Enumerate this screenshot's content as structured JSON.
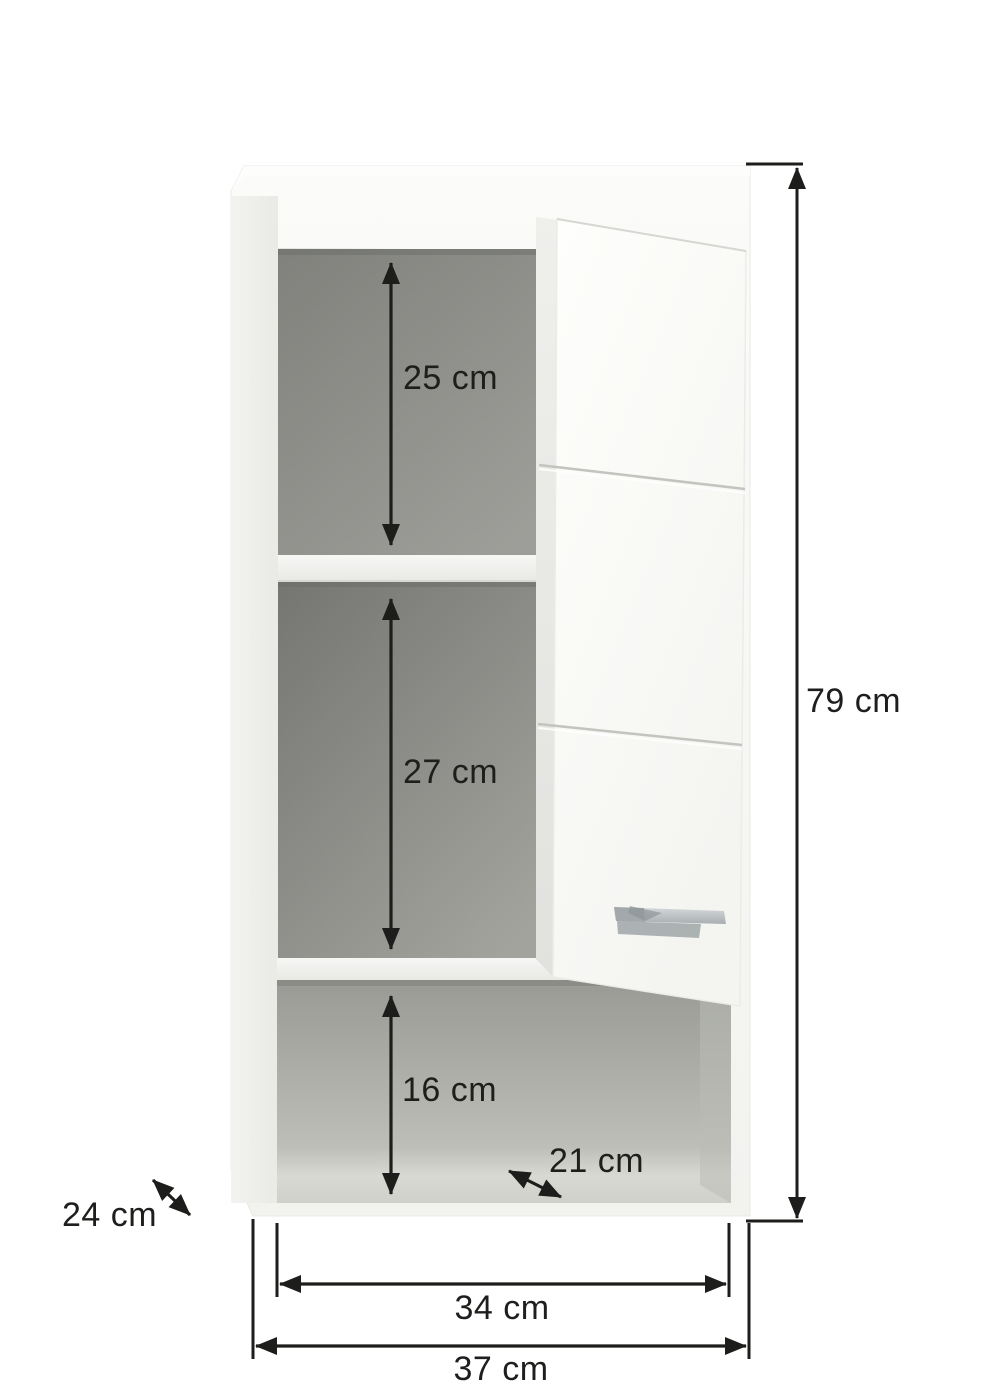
{
  "diagram": {
    "kind": "product-dimension-diagram",
    "subject": "Wall-mounted cabinet with one open door, two shelves and an open bottom compartment",
    "unit": "cm",
    "background_color": "#ffffff",
    "line_color": "#1d1d1b",
    "cabinet_colors": {
      "body_white": "#f8f8f6",
      "interior_gray_dark": "#757672",
      "interior_gray_light": "#cdcec8",
      "handle_silver": "#b6babd"
    },
    "dimensions": {
      "top_compartment_height": {
        "label": "25 cm",
        "value": 25,
        "orientation": "vertical"
      },
      "middle_compartment_height": {
        "label": "27 cm",
        "value": 27,
        "orientation": "vertical"
      },
      "bottom_compartment_height": {
        "label": "16 cm",
        "value": 16,
        "orientation": "vertical"
      },
      "bottom_compartment_depth": {
        "label": "21 cm",
        "value": 21,
        "orientation": "diagonal"
      },
      "cabinet_depth": {
        "label": "24 cm",
        "value": 24,
        "orientation": "diagonal"
      },
      "cabinet_height": {
        "label": "79 cm",
        "value": 79,
        "orientation": "vertical"
      },
      "interior_width": {
        "label": "34 cm",
        "value": 34,
        "orientation": "horizontal"
      },
      "cabinet_width": {
        "label": "37 cm",
        "value": 37,
        "orientation": "horizontal"
      }
    }
  }
}
